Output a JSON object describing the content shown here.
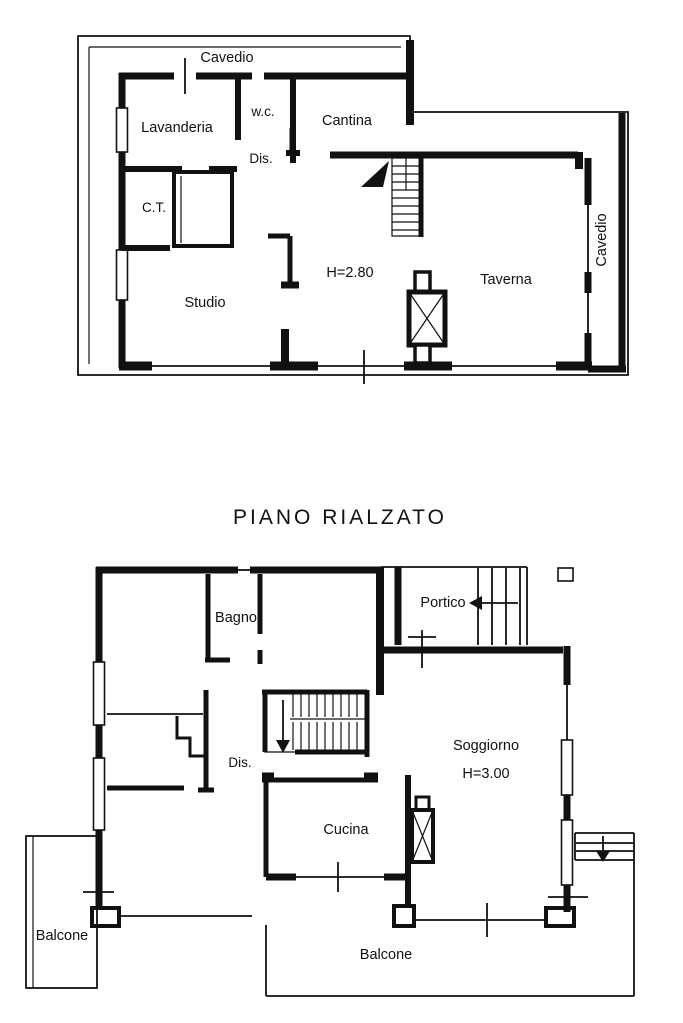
{
  "colors": {
    "ink": "#111111",
    "paper": "#ffffff"
  },
  "basement_plan": {
    "labels": {
      "cavedio_top": "Cavedio",
      "lavanderia": "Lavanderia",
      "wc": "w.c.",
      "cantina": "Cantina",
      "dis": "Dis.",
      "ct": "C.T.",
      "studio": "Studio",
      "height": "H=2.80",
      "taverna": "Taverna",
      "cavedio_right": "Cavedio"
    }
  },
  "rialzato_plan": {
    "title": "PIANO RIALZATO",
    "labels": {
      "bagno": "Bagno",
      "portico": "Portico",
      "dis": "Dis.",
      "soggiorno": "Soggiorno",
      "height": "H=3.00",
      "cucina": "Cucina",
      "balcone_left": "Balcone",
      "balcone_bottom": "Balcone"
    }
  }
}
